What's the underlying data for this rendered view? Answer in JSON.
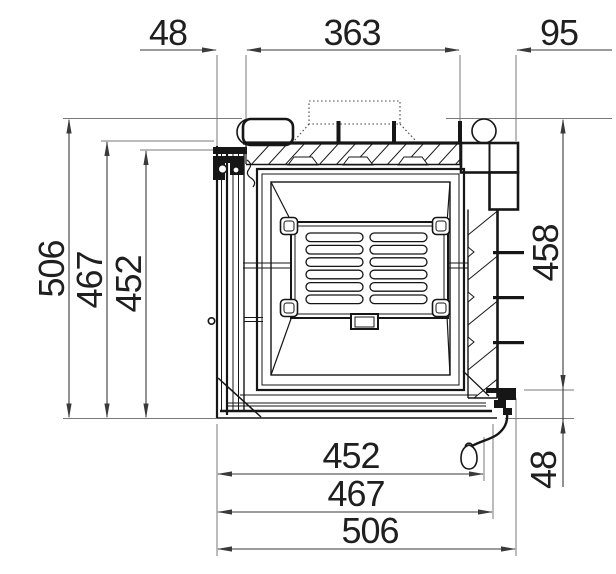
{
  "drawing": {
    "kind": "dimensioned technical drawing",
    "subject": "fireplace-insert-section"
  },
  "colors": {
    "line": "#161616",
    "dim_line": "#3a3a3a",
    "ext_line": "#7a7a7a",
    "text": "#1f1f1f",
    "background": "#ffffff"
  },
  "dims": {
    "top": {
      "d48": "48",
      "d363": "363",
      "d95": "95"
    },
    "left": {
      "d506": "506",
      "d467": "467",
      "d452": "452"
    },
    "right": {
      "d458": "458",
      "d48": "48"
    },
    "bottom": {
      "d452": "452",
      "d467": "467",
      "d506": "506"
    }
  }
}
